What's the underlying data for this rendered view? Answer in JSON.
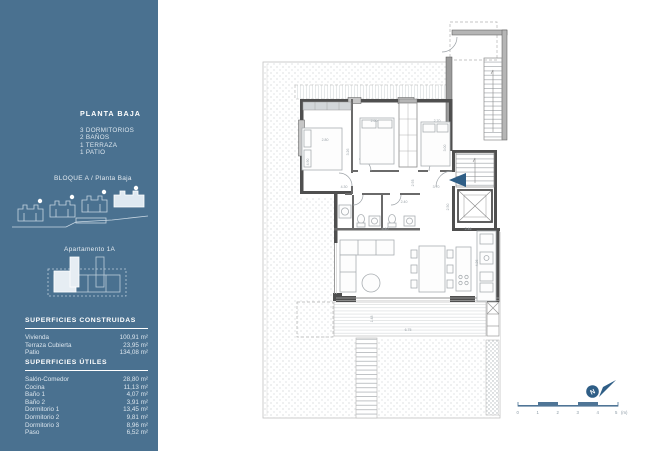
{
  "sidebar": {
    "background_color": "#4A7190",
    "title": "PLANTA BAJA",
    "amenities": [
      "3 DORMITORIOS",
      "2 BAÑOS",
      "1 TERRAZA",
      "1 PATIO"
    ],
    "block_label": "BLOQUE A / Planta Baja",
    "apartment_label": "Apartamento 1A",
    "superficies_construidas": {
      "heading": "SUPERFICIES CONSTRUIDAS",
      "rows": [
        {
          "label": "Vivienda",
          "value": "100,91 m²"
        },
        {
          "label": "Terraza Cubierta",
          "value": "23,95 m²"
        },
        {
          "label": "Patio",
          "value": "134,08 m²"
        }
      ]
    },
    "superficies_utiles": {
      "heading": "SUPERFICIES ÚTILES",
      "rows": [
        {
          "label": "Salón-Comedor",
          "value": "28,80 m²"
        },
        {
          "label": "Cocina",
          "value": "11,13 m²"
        },
        {
          "label": "Baño 1",
          "value": "4,07 m²"
        },
        {
          "label": "Baño 2",
          "value": "3,91 m²"
        },
        {
          "label": "Dormitorio 1",
          "value": "13,45 m²"
        },
        {
          "label": "Dormitorio 2",
          "value": "9,81 m²"
        },
        {
          "label": "Dormitorio 3",
          "value": "8,96 m²"
        },
        {
          "label": "Paso",
          "value": "6,52 m²"
        }
      ]
    }
  },
  "plan": {
    "accent_color": "#2F5E86",
    "north_label": "N",
    "scale_bar": {
      "labels": [
        "0",
        "1",
        "2",
        "3",
        "4",
        "5"
      ],
      "unit": "(m)"
    },
    "dimensions": [
      {
        "text": "2.80"
      },
      {
        "text": "2.60"
      },
      {
        "text": "2.70"
      },
      {
        "text": "3.26"
      },
      {
        "text": "3.00"
      },
      {
        "text": "4.90"
      },
      {
        "text": "4.30"
      },
      {
        "text": "3.70"
      },
      {
        "text": "2.93"
      },
      {
        "text": "2.40"
      },
      {
        "text": "8.40"
      },
      {
        "text": "2.46"
      },
      {
        "text": "4.26"
      },
      {
        "text": "6.75"
      },
      {
        "text": "1.48"
      },
      {
        "text": "2.50"
      }
    ]
  }
}
